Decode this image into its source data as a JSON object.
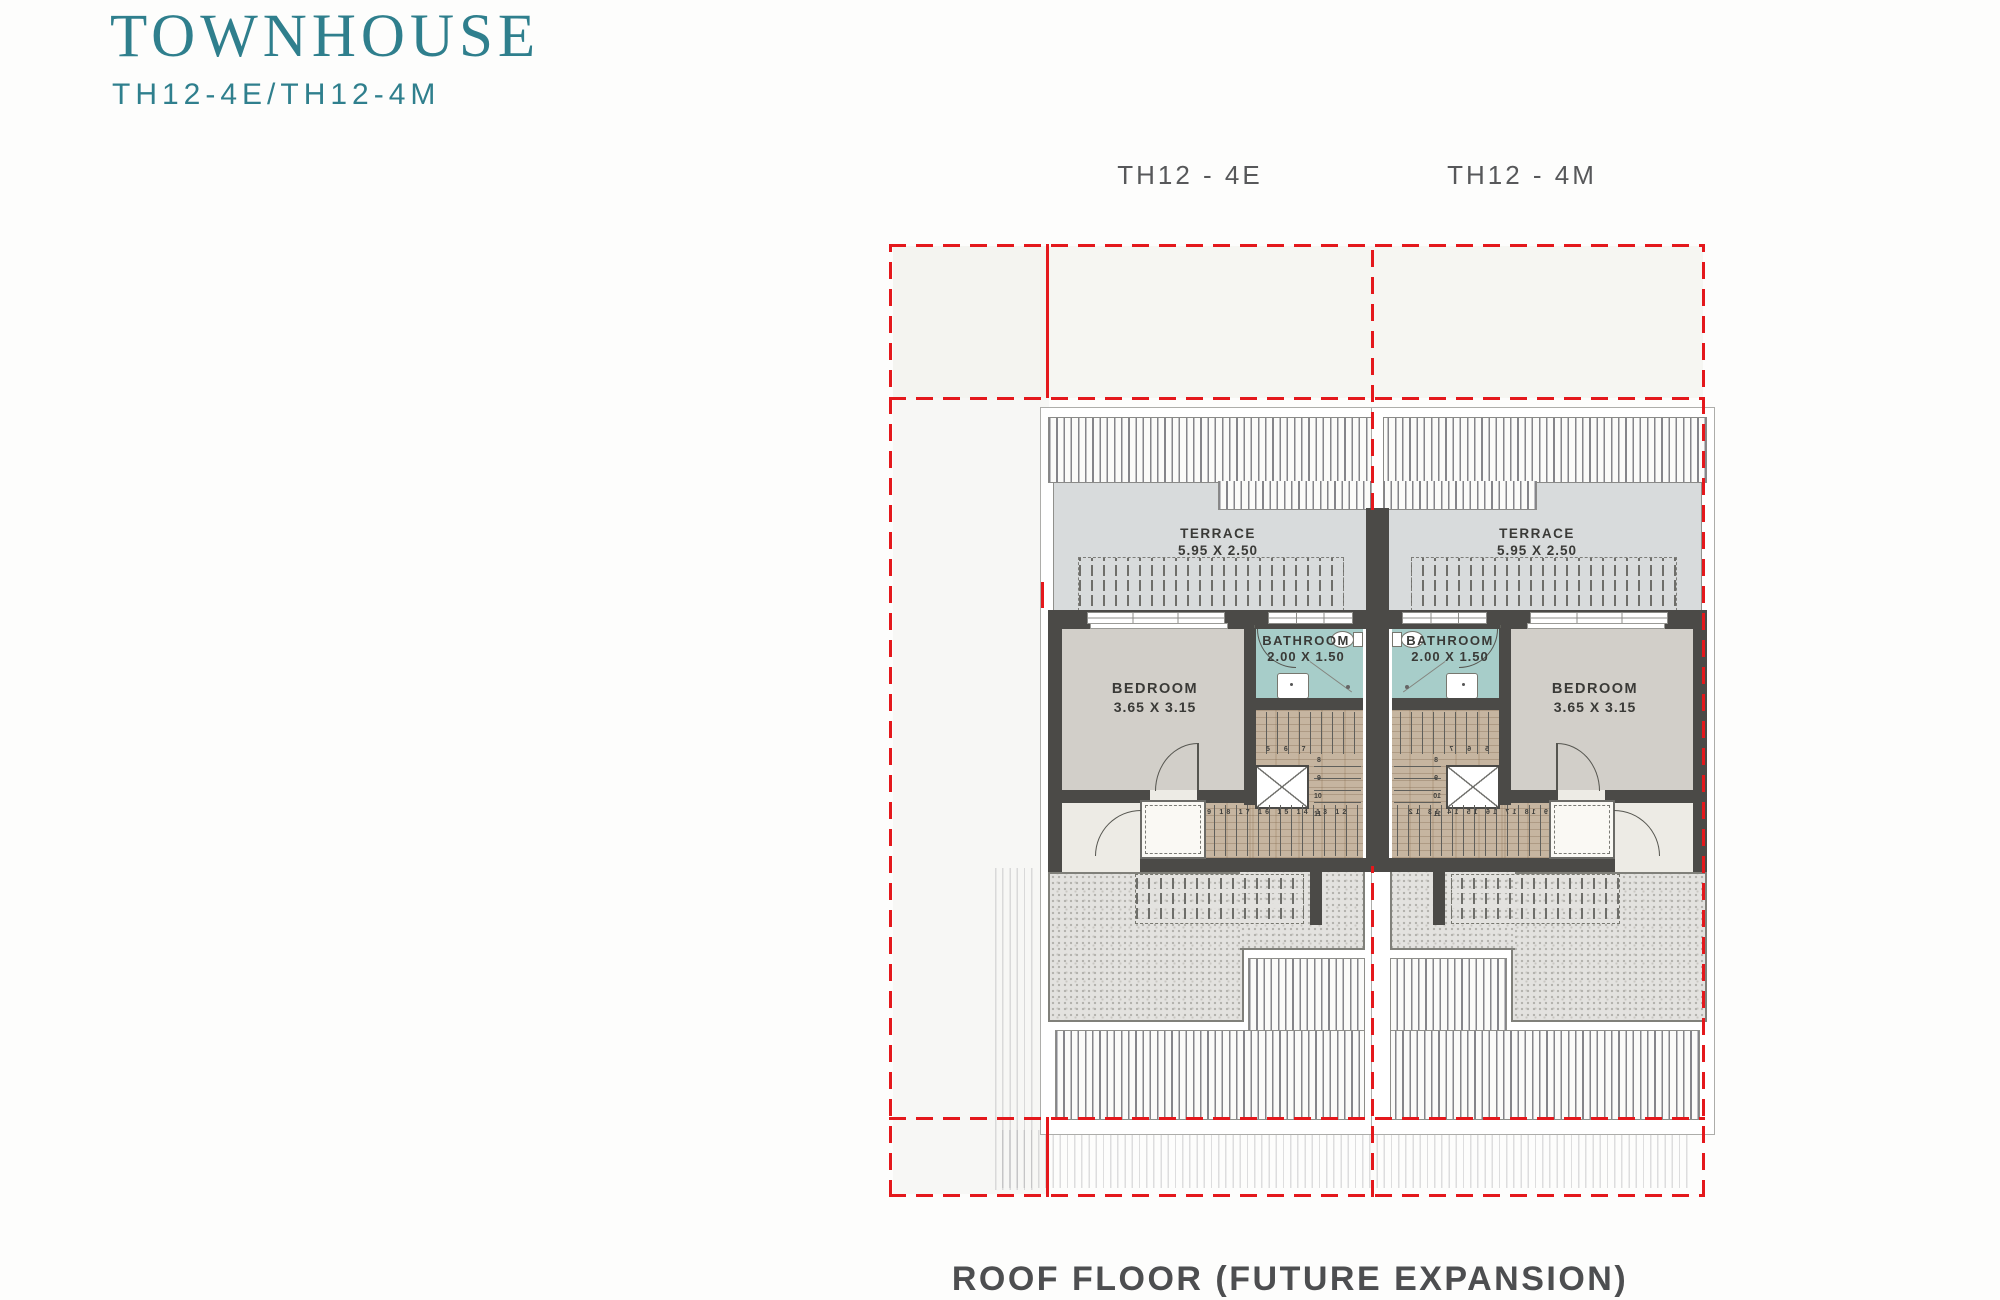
{
  "header": {
    "title": "TOWNHOUSE",
    "subtitle": "TH12-4E/TH12-4M"
  },
  "unit_labels": {
    "left": "TH12 - 4E",
    "right": "TH12 - 4M"
  },
  "caption": "ROOF FLOOR (FUTURE EXPANSION)",
  "rooms": {
    "terrace": {
      "name": "TERRACE",
      "dims": "5.95 X 2.50"
    },
    "bathroom": {
      "name": "BATHROOM",
      "dims": "2.00 X 1.50"
    },
    "bedroom": {
      "name": "BEDROOM",
      "dims": "3.65 X 3.15"
    }
  },
  "stairs": {
    "top_row": "5 6 7",
    "side": [
      "8",
      "9",
      "10",
      "11"
    ],
    "bottom_row": "19 18 17 16 15 14 13 12"
  },
  "colors": {
    "accent_teal": "#2f7f8d",
    "boundary_red": "#e4181c",
    "wall_dark": "#4b4a47",
    "bathroom_tile": "#a7cdc9",
    "stair_wood": "#c6b5a0",
    "label_gray": "#4d4e50"
  }
}
